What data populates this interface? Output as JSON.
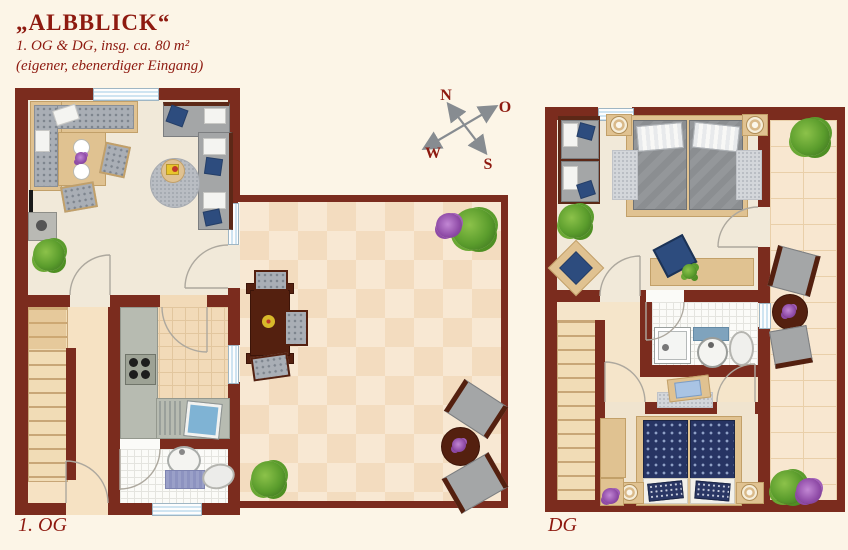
{
  "header": {
    "title": "„ALBBLICK“",
    "subtitle": "1. OG & DG, insg. ca. 80 m²",
    "note": "(eigener, ebenerdiger Eingang)"
  },
  "compass": {
    "north": "N",
    "east": "O",
    "south": "S",
    "west": "W"
  },
  "floors": {
    "og": {
      "label": "1. OG"
    },
    "dg": {
      "label": "DG"
    }
  },
  "colors": {
    "background": "#fcf5e7",
    "wall": "#7b2c1e",
    "accent_text": "#8e1a10",
    "window_glass": "#cfe4f1",
    "terrace_tile_light": "#f8e8d3",
    "terrace_tile_dark": "#f3dcbf",
    "balcony_stone": "#f8e7d0",
    "wood": "#e0c291",
    "dark_wood": "#54200f",
    "upholstery_gray": "#a4a6a7",
    "pillow_blue": "#2d4c7e",
    "bed_navy": "#273463",
    "counter_gray": "#b7bbb1",
    "plant_green": "#5a9c2c",
    "flower_purple": "#8e4aa6",
    "compass_arrow": "#878c91"
  }
}
